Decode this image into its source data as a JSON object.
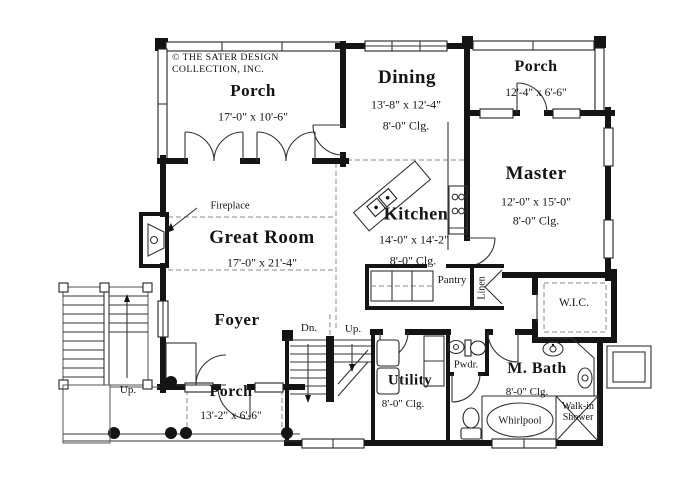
{
  "branding": {
    "line1": "© THE SATER DESIGN",
    "line2": "COLLECTION, INC."
  },
  "rooms": {
    "porch_top_left": {
      "name": "Porch",
      "dims": "17'-0\" x 10'-6\""
    },
    "dining": {
      "name": "Dining",
      "dims": "13'-8\" x 12'-4\"",
      "ceiling": "8'-0\" Clg."
    },
    "porch_top_right": {
      "name": "Porch",
      "dims": "12'-4\" x 6'-6\""
    },
    "master": {
      "name": "Master",
      "dims": "12'-0\" x 15'-0\"",
      "ceiling": "8'-0\" Clg."
    },
    "great_room": {
      "name": "Great Room",
      "dims": "17'-0\" x 21'-4\""
    },
    "kitchen": {
      "name": "Kitchen",
      "dims": "14'-0\" x 14'-2\"",
      "ceiling": "8'-0\" Clg."
    },
    "foyer": {
      "name": "Foyer"
    },
    "porch_bottom": {
      "name": "Porch",
      "dims": "13'-2\" x 6'-6\""
    },
    "utility": {
      "name": "Utility",
      "ceiling": "8'-0\" Clg."
    },
    "m_bath": {
      "name": "M. Bath",
      "ceiling": "8'-0\" Clg."
    },
    "wic": {
      "name": "W.I.C."
    },
    "pantry": {
      "name": "Pantry"
    },
    "linen": {
      "name": "Linen"
    },
    "pwdr": {
      "name": "Pwdr."
    },
    "whirlpool": {
      "name": "Whirlpool"
    },
    "walkin_shower": {
      "line1": "Walk-in",
      "line2": "Shower"
    }
  },
  "annotations": {
    "fireplace": "Fireplace",
    "stairs_down": "Dn.",
    "stairs_up_center": "Up.",
    "stairs_up_left": "Up."
  }
}
